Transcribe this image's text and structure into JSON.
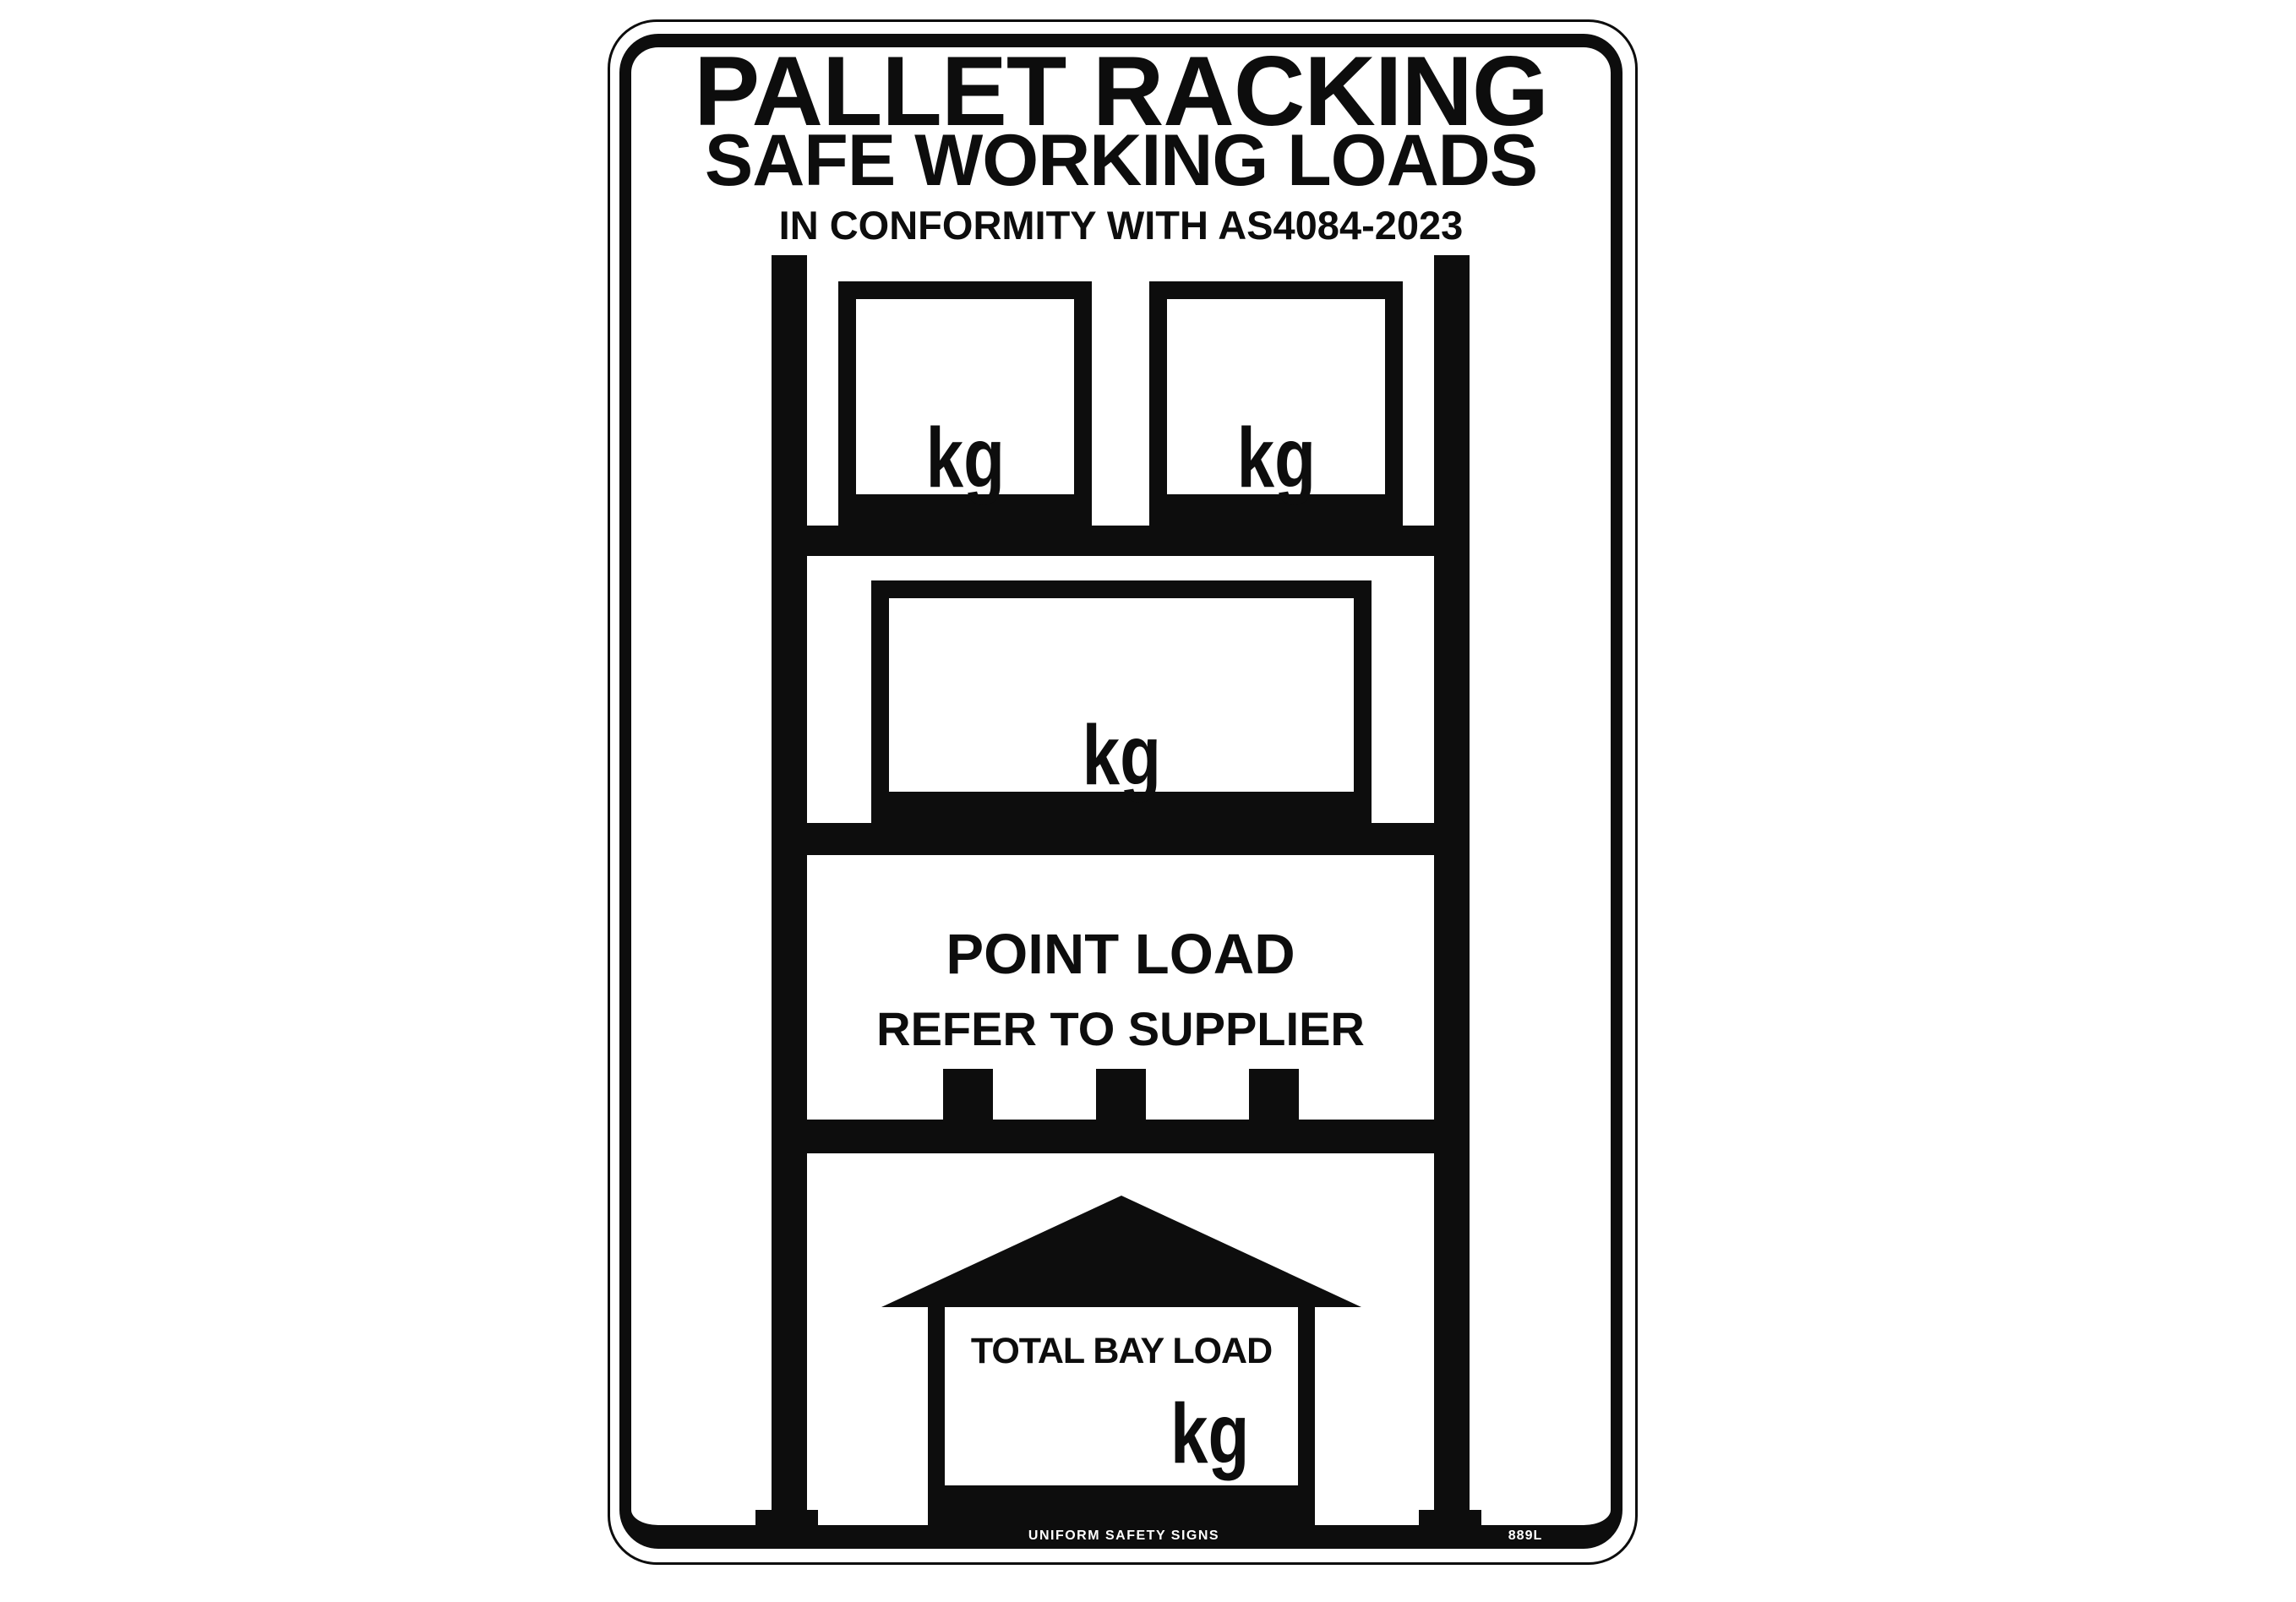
{
  "sign": {
    "heading": {
      "line1": "PALLET RACKING",
      "line2": "SAFE WORKING LOADS",
      "line3": "IN CONFORMITY WITH AS4084-2023"
    },
    "rack": {
      "top_shelf": {
        "left_box_unit": "kg",
        "right_box_unit": "kg"
      },
      "middle_shelf": {
        "box_unit": "kg"
      },
      "point_load": {
        "title": "POINT LOAD",
        "subtitle": "REFER TO SUPPLIER"
      },
      "total_bay": {
        "label": "TOTAL BAY LOAD",
        "unit": "kg"
      }
    },
    "footer": {
      "brand": "UNIFORM SAFETY SIGNS",
      "catalog_code": "889L"
    },
    "colors": {
      "ink": "#0d0d0d",
      "paper": "#ffffff"
    }
  }
}
